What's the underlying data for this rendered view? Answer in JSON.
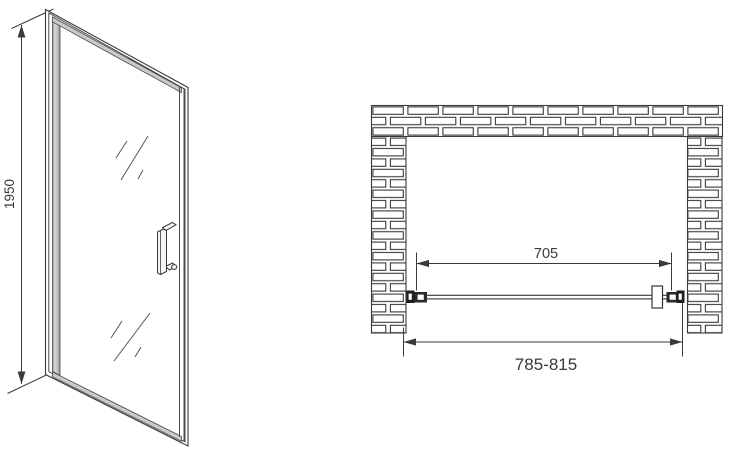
{
  "front_view": {
    "height_dimension_label": "1950"
  },
  "plan_view": {
    "glass_width_dimension_label": "705",
    "opening_width_dimension_label": "785-815"
  },
  "colors": {
    "line": "#3a3a3a",
    "frame_fill": "#c9c9c9",
    "profile_dark_fill": "#1e1e1e",
    "background": "#ffffff"
  }
}
